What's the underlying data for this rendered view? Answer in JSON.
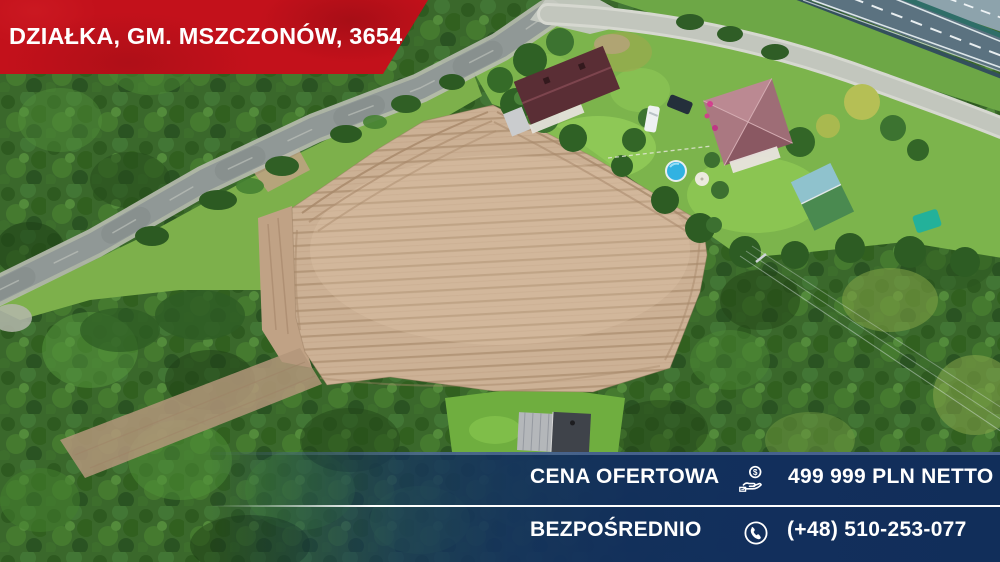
{
  "red_banner": {
    "title": "DZIAŁKA, GM. MSZCZONÓW, 3654 m",
    "title_sup": "2"
  },
  "info_banner": {
    "rows": [
      {
        "label": "CENA OFERTOWA",
        "icon": "hand-coin-icon",
        "value": "499 999 PLN NETTO"
      },
      {
        "label": "BEZPOŚREDNIO",
        "icon": "phone-circle-icon",
        "value": "(+48) 510-253-077"
      }
    ]
  },
  "colors": {
    "banner_red": "#c3111b",
    "banner_blue": "#122f5c",
    "text_white": "#ffffff",
    "field_tan": "#ccb195",
    "forest_green": "#3a682b",
    "pool_blue": "#31b2e2"
  }
}
